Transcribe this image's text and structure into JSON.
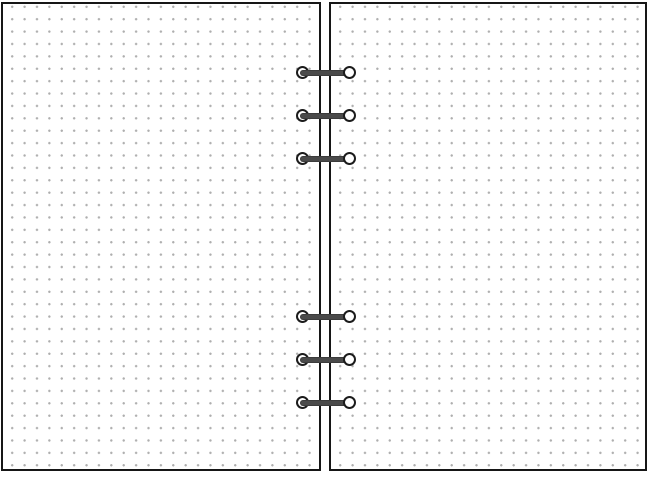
{
  "notebook": {
    "description": "open ring-bound planner spread with two blank dot-grid pages",
    "pages": [
      {
        "id": "left-page",
        "pattern": "dot-grid",
        "content": ""
      },
      {
        "id": "right-page",
        "pattern": "dot-grid",
        "content": ""
      }
    ],
    "dot_grid": {
      "pitch_px": 12.4,
      "dot_diameter_px": 2
    },
    "binding": {
      "ring_count": 6,
      "groups": [
        {
          "name": "top-ring-group",
          "rings_y": [
            73,
            116,
            159
          ]
        },
        {
          "name": "bottom-ring-group",
          "rings_y": [
            317,
            360,
            403
          ]
        }
      ]
    },
    "colors": {
      "page_bg": "#ffffff",
      "page_border": "#161616",
      "dot": "#aeaeae",
      "bar": "#4a4a4a",
      "eyelet_border": "#1c1c1c",
      "eyelet_fill": "#ffffff"
    }
  }
}
